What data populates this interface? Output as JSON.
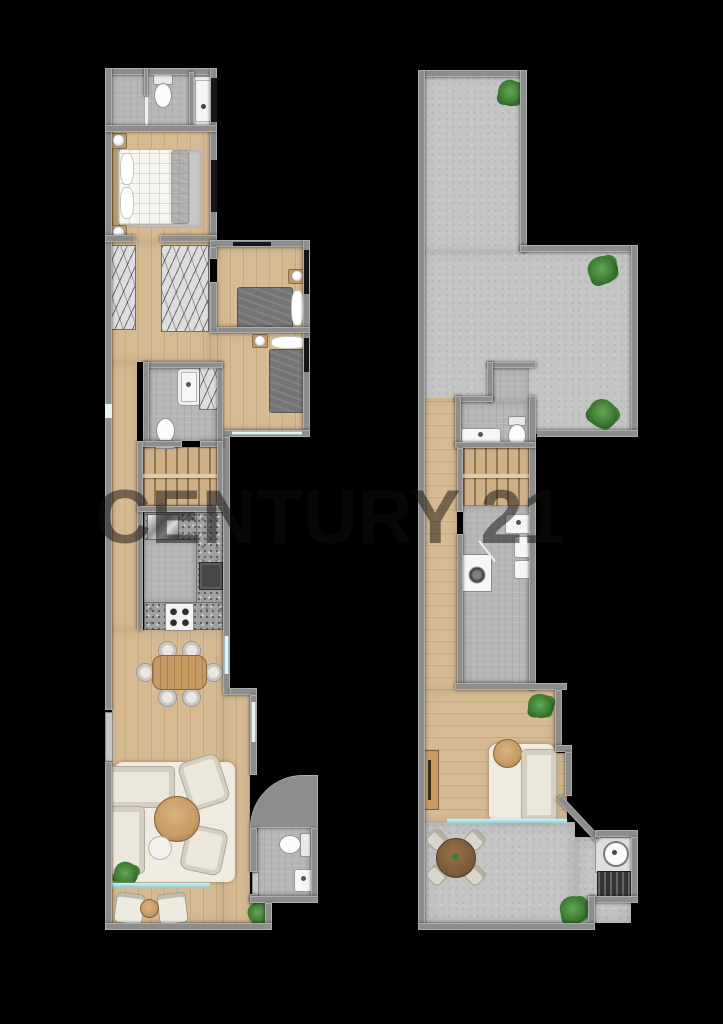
{
  "image": {
    "type": "real-estate-floor-plan-render",
    "background": "#000000"
  },
  "watermark": {
    "text": "CENTURY 21"
  },
  "palette": {
    "wall": "#8d8d8d",
    "wood": "#d6ba92",
    "stair_wood": "#cdb087",
    "tile": "#b6b6b6",
    "concrete": "#c4c4c4",
    "granite": "#a0a0a0",
    "rug": "#efebe1",
    "sofa": "#ebe7da",
    "blanket": "#747474",
    "glass": "#8fd0d6",
    "plant": "#3f7d33",
    "table_wood": "#c79a63",
    "white_item": "#f6f6f4",
    "watermark_color": "rgba(15,13,10,0.5)"
  },
  "plans": {
    "left": {
      "id": "main-unit-floor-plan",
      "rooms": [
        "bathroom",
        "master-bedroom",
        "wardrobe-hallway",
        "bedroom-2",
        "bedroom-3",
        "bathroom-2",
        "staircase",
        "kitchen",
        "dining-area",
        "living-room",
        "balcony",
        "guest-wc"
      ],
      "furniture": [
        "bathtub",
        "toilet",
        "shower",
        "double-bed",
        "nightstand",
        "table-lamp",
        "wardrobe",
        "single-bed",
        "stairs",
        "kitchen-sink",
        "oven",
        "cooktop",
        "dining-table",
        "dining-chair",
        "entrance-door",
        "sectional-sofa",
        "armchair",
        "coffee-table",
        "area-rug",
        "potted-plant",
        "balcony-chair",
        "balcony-table",
        "toilet",
        "washbasin"
      ]
    },
    "right": {
      "id": "roof-terrace-floor-plan",
      "rooms": [
        "roof-terrace",
        "bathroom",
        "hallway",
        "staircase",
        "laundry-room",
        "living-room",
        "lower-terrace",
        "bbq-corner"
      ],
      "furniture": [
        "potted-plant",
        "washbasin",
        "toilet",
        "stairs",
        "washing-machine",
        "boiler",
        "sofa",
        "side-table",
        "area-rug",
        "sideboard",
        "outdoor-dining-table",
        "outdoor-chair",
        "outdoor-sink",
        "bbq-grill"
      ]
    }
  }
}
